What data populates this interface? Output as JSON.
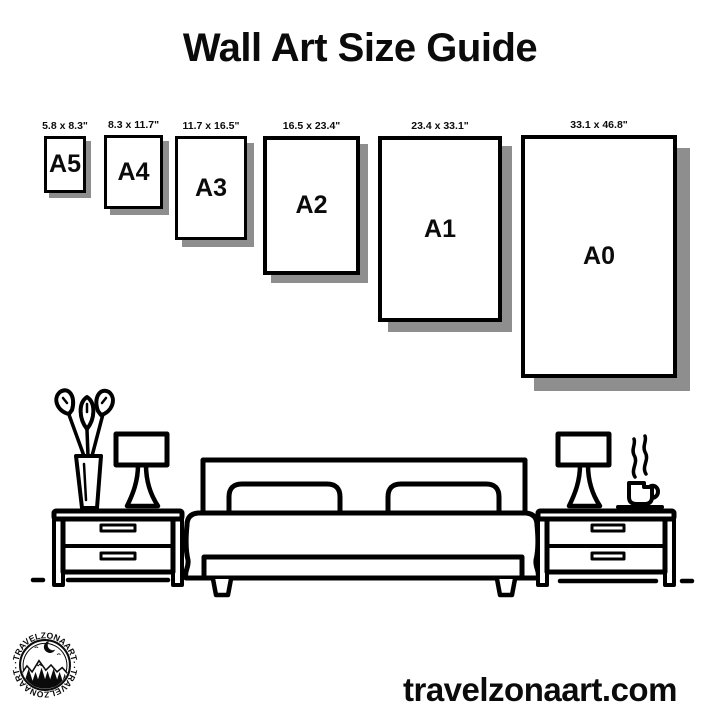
{
  "page": {
    "title": "Wall Art Size Guide",
    "background_color": "#ffffff",
    "text_color": "#0b0b0b"
  },
  "size_guide": {
    "unit": "inches",
    "paper_color": "#ffffff",
    "border_color": "#000000",
    "shadow_color": "#8e8e8e",
    "sizes": [
      {
        "name": "A5",
        "dimensions": "5.8 x 8.3\"",
        "x": 44,
        "y": 136,
        "w": 42,
        "h": 57,
        "shadow": 5
      },
      {
        "name": "A4",
        "dimensions": "8.3 x 11.7\"",
        "x": 104,
        "y": 135,
        "w": 59,
        "h": 74,
        "shadow": 6
      },
      {
        "name": "A3",
        "dimensions": "11.7 x 16.5\"",
        "x": 175,
        "y": 136,
        "w": 72,
        "h": 104,
        "shadow": 7
      },
      {
        "name": "A2",
        "dimensions": "16.5 x 23.4\"",
        "x": 263,
        "y": 136,
        "w": 97,
        "h": 139,
        "shadow": 8
      },
      {
        "name": "A1",
        "dimensions": "23.4 x 33.1\"",
        "x": 378,
        "y": 136,
        "w": 124,
        "h": 186,
        "shadow": 10
      },
      {
        "name": "A0",
        "dimensions": "33.1 x 46.8\"",
        "x": 521,
        "y": 135,
        "w": 156,
        "h": 243,
        "shadow": 13
      }
    ]
  },
  "branding": {
    "badge_text": "·TRAVELZONAART·",
    "website": "travelzonaart.com"
  }
}
